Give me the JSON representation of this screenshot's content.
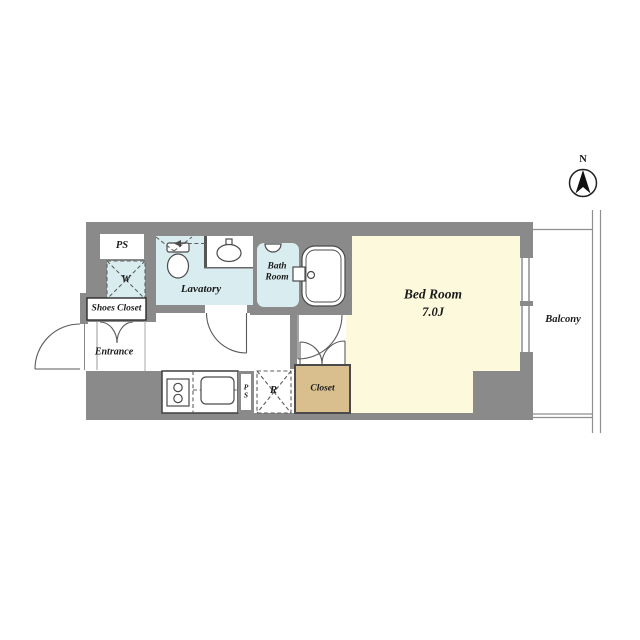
{
  "compass": {
    "label": "N"
  },
  "rooms": {
    "ps_top": {
      "label": "PS"
    },
    "washer": {
      "label": "W"
    },
    "lavatory": {
      "label": "Lavatory"
    },
    "bathroom": {
      "line1": "Bath",
      "line2": "Room"
    },
    "shoes_closet": {
      "label": "Shoes Closet"
    },
    "entrance": {
      "label": "Entrance"
    },
    "bedroom": {
      "name": "Bed Room",
      "size": "7.0J"
    },
    "closet": {
      "label": "Closet"
    },
    "refrigerator": {
      "label": "R"
    },
    "ps_bottom": {
      "line1": "P",
      "line2": "S"
    },
    "balcony": {
      "label": "Balcony"
    }
  },
  "colors": {
    "wall": "#8a8a8a",
    "water": "#d9edf1",
    "bedroom": "#fcf9dc",
    "closet": "#d8bf8d",
    "line": "#4a4a4a",
    "text": "#1b1b1b"
  }
}
